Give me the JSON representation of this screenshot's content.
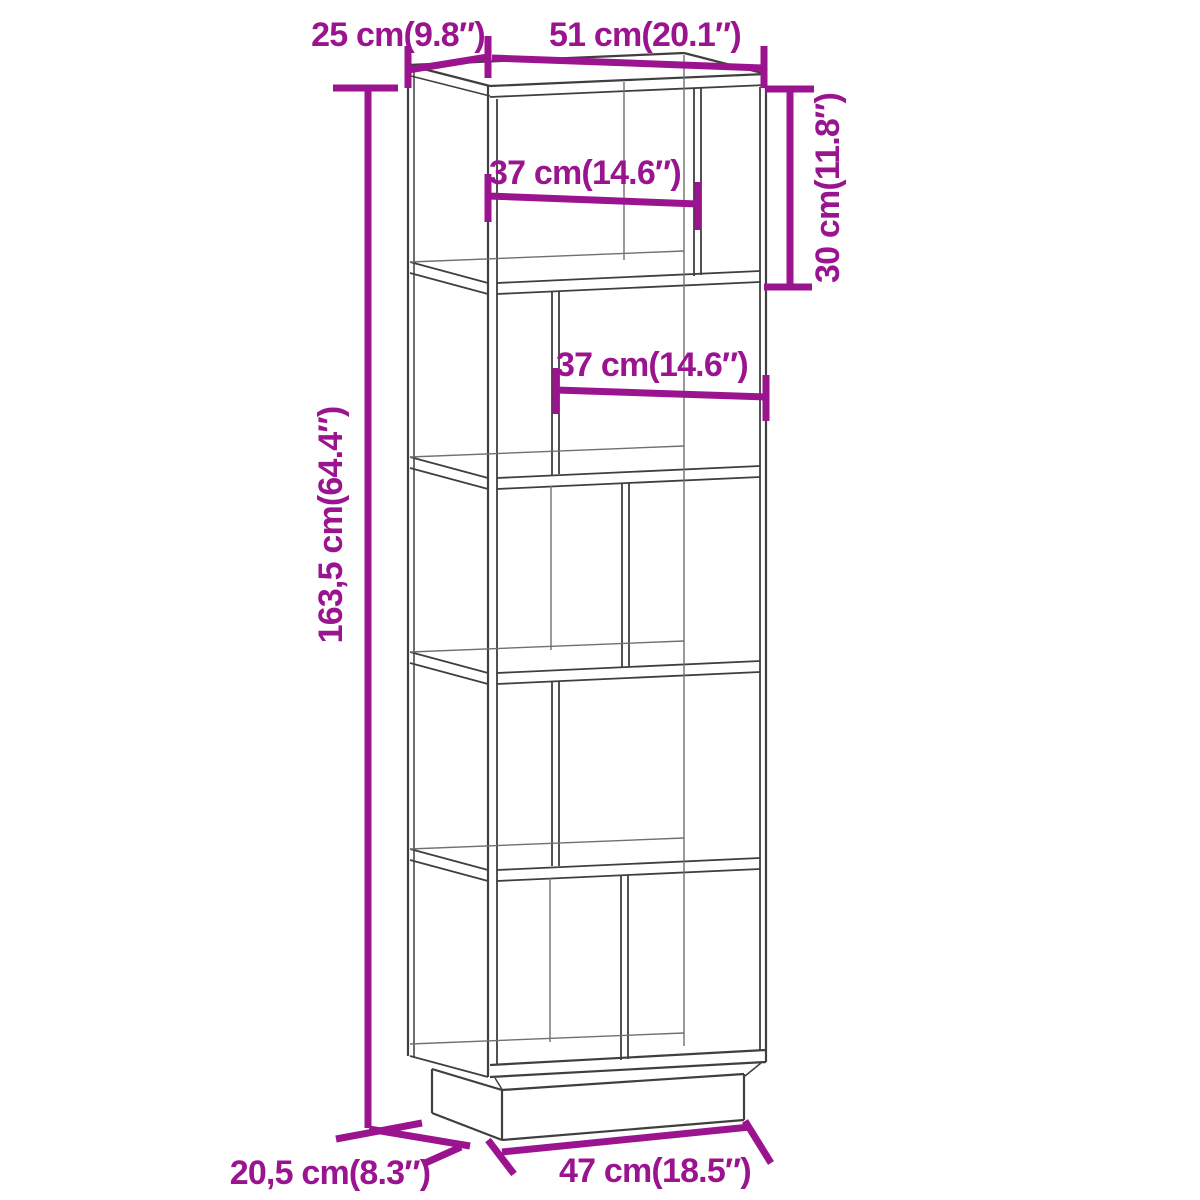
{
  "theme": {
    "background": "#ffffff",
    "accent": "#9B148F",
    "line_color": "#3f3f3f",
    "back_line_color": "#707070"
  },
  "diagram": {
    "subject": "book-cabinet-room-divider-line-drawing",
    "sections": 5
  },
  "dimensions": {
    "top_depth": "25 cm(9.8″)",
    "top_width": "51 cm(20.1″)",
    "shelf1_inner_width": "37 cm(14.6″)",
    "shelf2_inner_width": "37 cm(14.6″)",
    "section_height": "30 cm(11.8″)",
    "total_height": "163,5 cm(64.4″)",
    "base_depth": "20,5 cm(8.3″)",
    "base_width": "47 cm(18.5″)"
  }
}
